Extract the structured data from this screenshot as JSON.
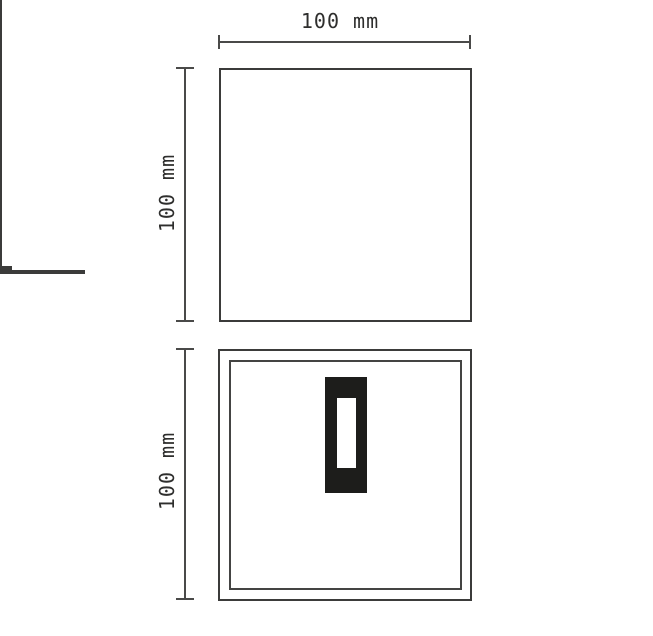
{
  "diagram": {
    "type": "technical-drawing",
    "description": "Two-view dimensioned drawing of a square wall fixture with central LED module",
    "views": {
      "top": {
        "name": "top-view",
        "width_label": "100 mm",
        "height_label": "100 mm",
        "width_mm": 100,
        "height_mm": 100
      },
      "front": {
        "name": "front-view",
        "height_label": "100 mm",
        "height_mm": 100
      }
    },
    "colors": {
      "line": "#3b3b3a",
      "dimension_line": "#4a4a49",
      "module_fill": "#1d1d1b",
      "background": "#ffffff",
      "text": "#2e2e2d"
    }
  }
}
